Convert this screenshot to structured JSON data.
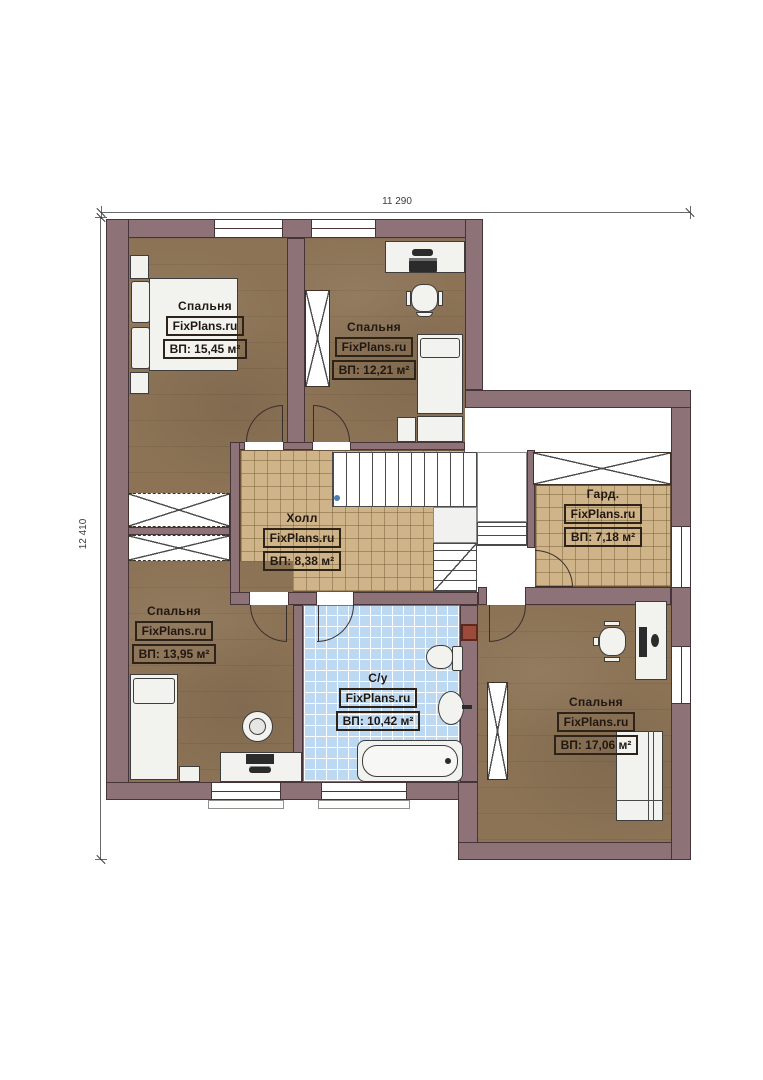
{
  "plan": {
    "type": "floor-plan",
    "dim_top": "11 290",
    "dim_left": "12 410",
    "watermark": "FixPlans.ru",
    "rooms": [
      {
        "id": "bedroom-top-left",
        "name": "Спальня",
        "brand": "FixPlans.ru",
        "area": "ВП: 15,45 м²"
      },
      {
        "id": "bedroom-top-middle",
        "name": "Спальня",
        "brand": "FixPlans.ru",
        "area": "ВП: 12,21 м²"
      },
      {
        "id": "hall",
        "name": "Холл",
        "brand": "FixPlans.ru",
        "area": "ВП: 8,38 м²"
      },
      {
        "id": "wardrobe",
        "name": "Гард.",
        "brand": "FixPlans.ru",
        "area": "ВП: 7,18 м²"
      },
      {
        "id": "bedroom-bottom-left",
        "name": "Спальня",
        "brand": "FixPlans.ru",
        "area": "ВП: 13,95 м²"
      },
      {
        "id": "bathroom",
        "name": "С/у",
        "brand": "FixPlans.ru",
        "area": "ВП: 10,42 м²"
      },
      {
        "id": "bedroom-bottom-right",
        "name": "Спальня",
        "brand": "FixPlans.ru",
        "area": "ВП: 17,06 м²"
      }
    ],
    "colors": {
      "wall": "#8d7377",
      "bedroom_floor": "#8c7356",
      "hall_floor": "#cfb489",
      "bath_floor": "#bdd9f2",
      "shaft_red": "#9c4a3c"
    },
    "icons": [
      "bed-icon",
      "pillow-icon",
      "nightstand-icon",
      "desk-icon",
      "printer-icon",
      "office-chair-icon",
      "monitor-icon",
      "keyboard-icon",
      "stool-icon",
      "toilet-icon",
      "sink-icon",
      "bathtub-icon",
      "sofa-icon",
      "wardrobe-x-icon",
      "stairs-icon",
      "door-arc-icon",
      "vent-shaft-icon"
    ]
  }
}
